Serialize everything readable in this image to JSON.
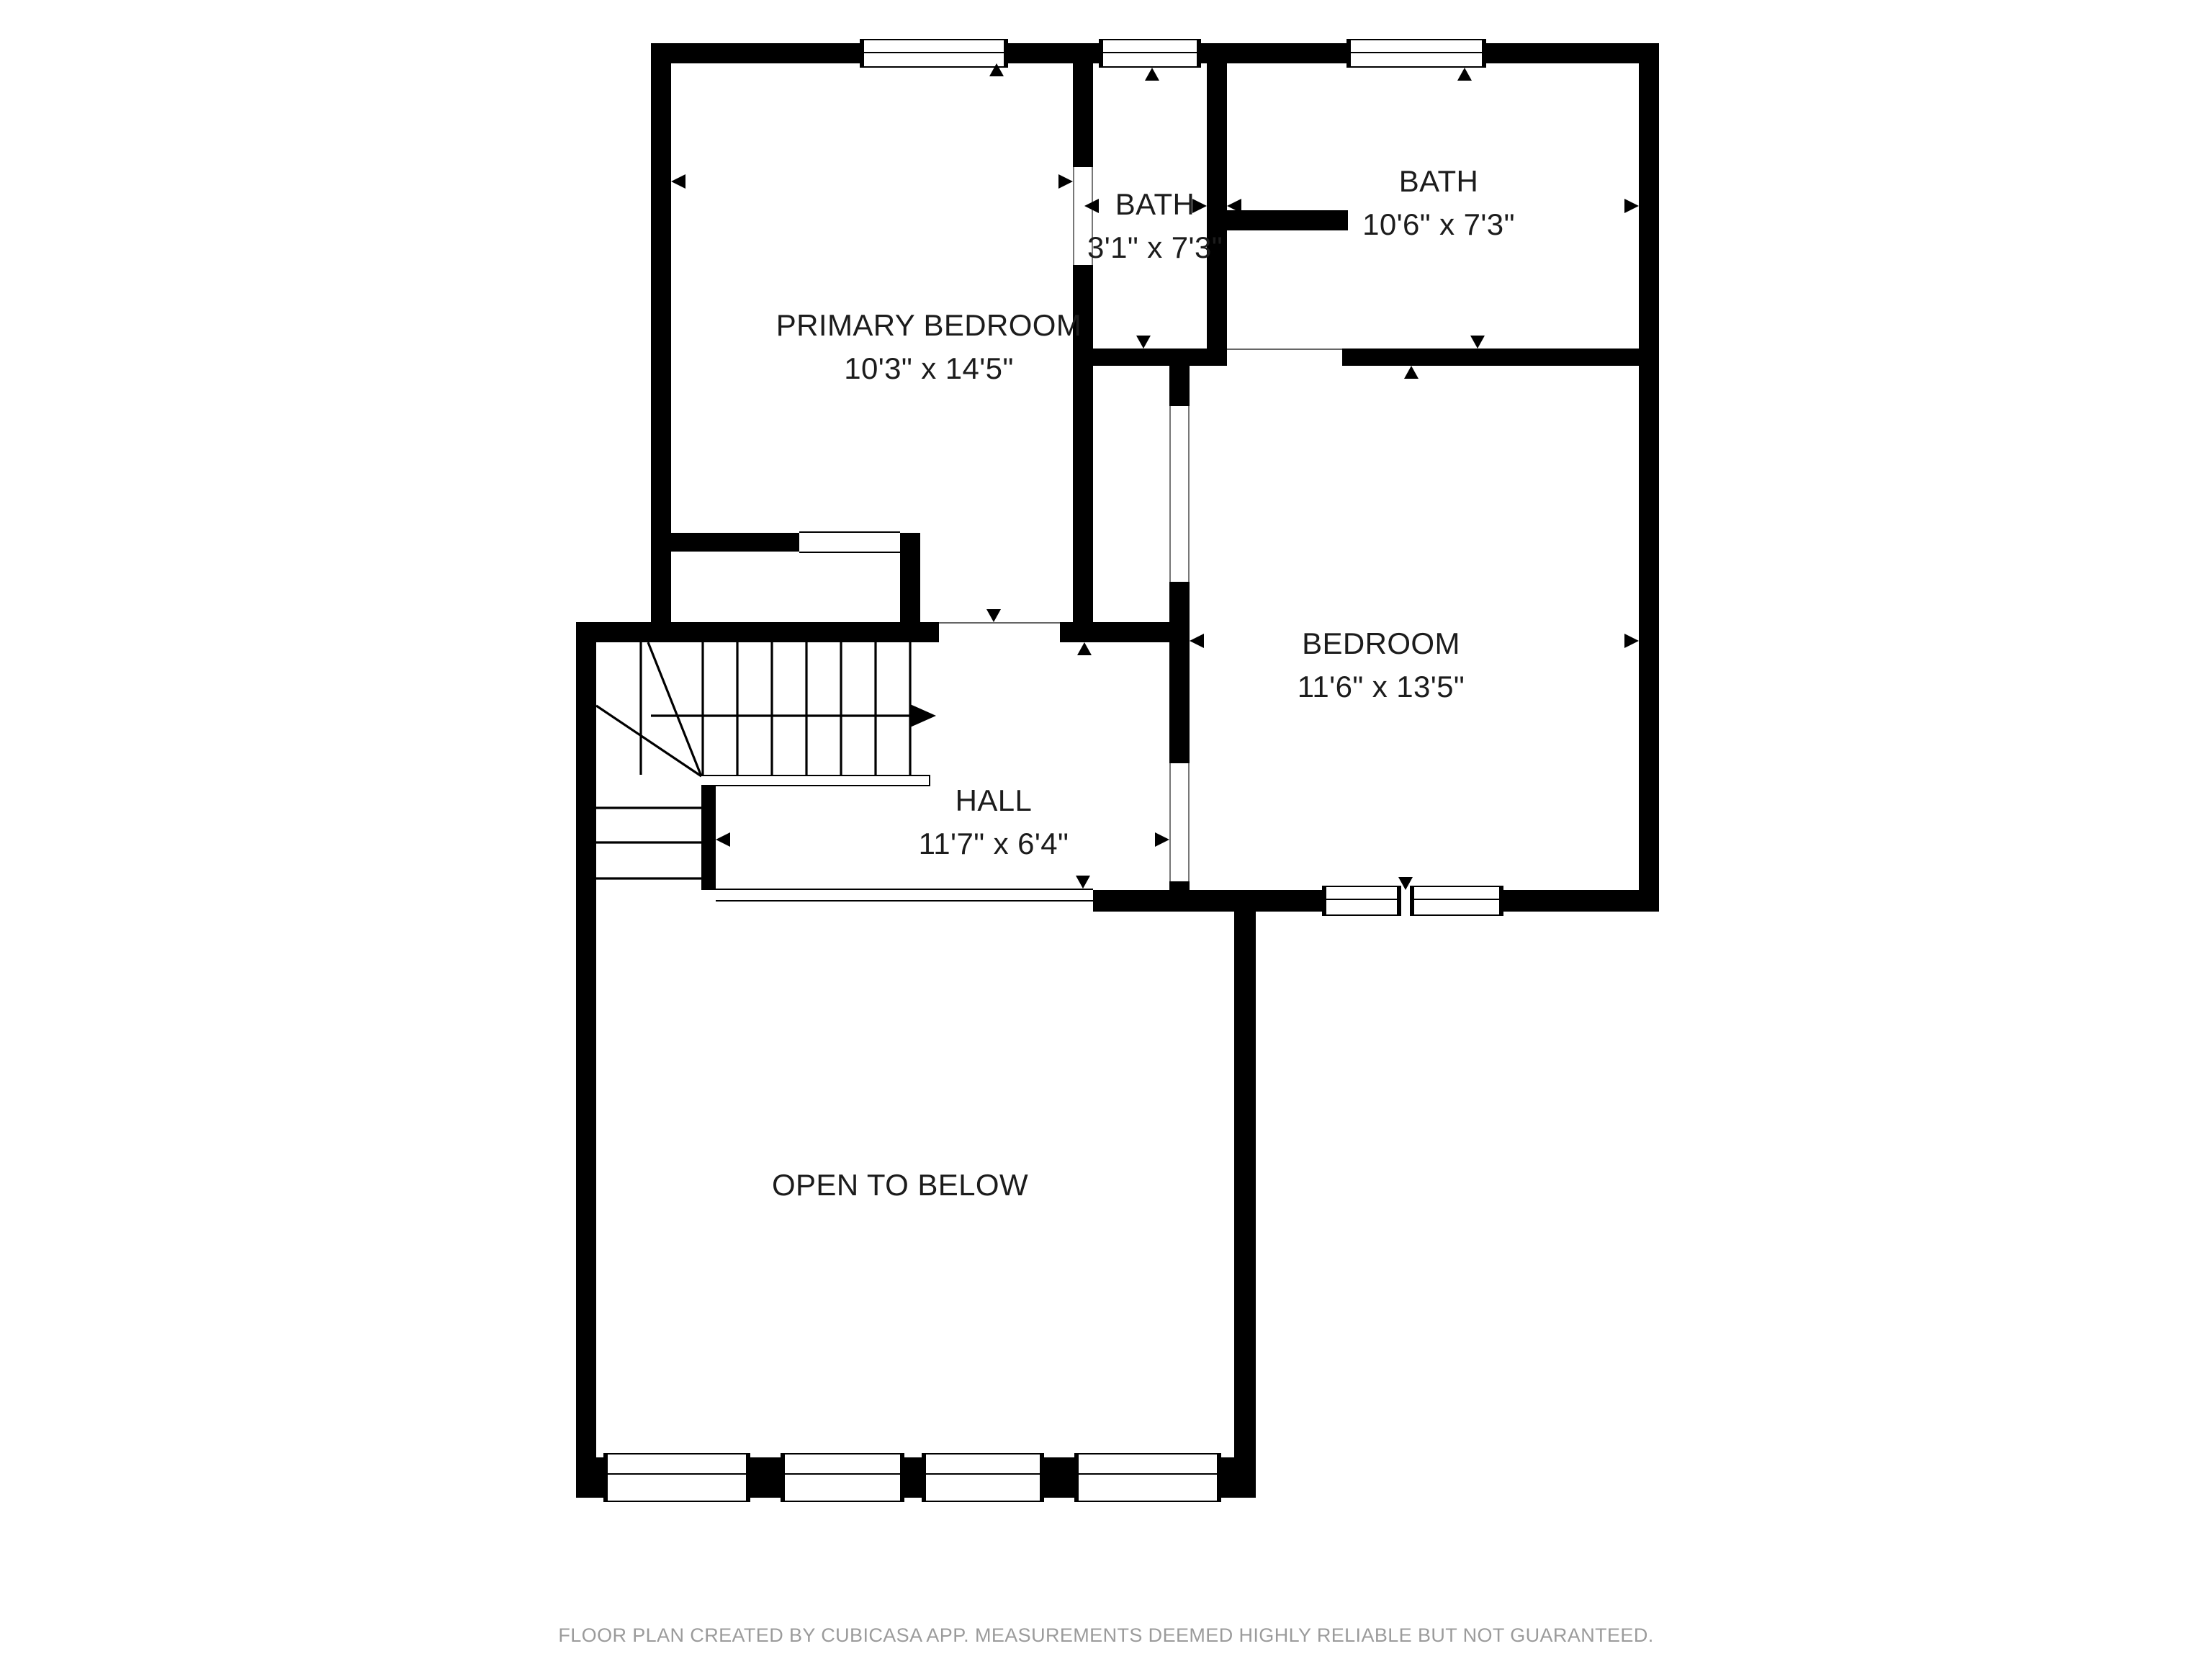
{
  "rooms": {
    "primary_bedroom": {
      "name": "PRIMARY BEDROOM",
      "dims": "10'3\" x 14'5\""
    },
    "bath_small": {
      "name": "BATH",
      "dims": "3'1\" x 7'3\""
    },
    "bath_large": {
      "name": "BATH",
      "dims": "10'6\" x 7'3\""
    },
    "bedroom": {
      "name": "BEDROOM",
      "dims": "11'6\" x 13'5\""
    },
    "hall": {
      "name": "HALL",
      "dims": "11'7\" x 6'4\""
    },
    "open_to_below": {
      "name": "OPEN TO BELOW"
    }
  },
  "footer": {
    "disclaimer": "FLOOR PLAN CREATED BY CUBICASA APP. MEASUREMENTS DEEMED HIGHLY RELIABLE BUT NOT GUARANTEED."
  },
  "icons": {
    "dimension_arrows": "small black triangles pointing toward room walls",
    "stairs_direction": "stairs-up-arrow"
  },
  "colors": {
    "wall": "#000000",
    "room_text": "#1c1c1c",
    "footer_text": "#9b9b9b",
    "background": "#ffffff",
    "opening_line": "#777777"
  }
}
